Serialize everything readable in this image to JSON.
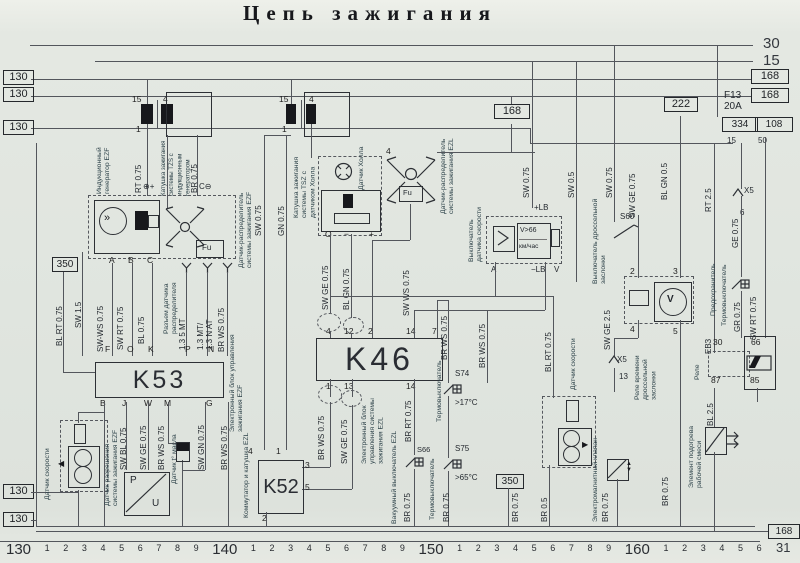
{
  "title": "Цепь зажигания",
  "tags": {
    "track": "130",
    "t168": "168",
    "t222": "222",
    "t350": "350",
    "t334": "334",
    "t108": "108",
    "bus30": "30",
    "bus15": "15",
    "bus31": "31"
  },
  "blocks": {
    "k53": {
      "id": "K53",
      "pins_top": [
        "F",
        "O",
        "K",
        "P",
        "N"
      ],
      "pins_bottom": [
        "B",
        "J",
        "W",
        "M",
        "G"
      ]
    },
    "k46": {
      "id": "K46",
      "pins_top": [
        "4",
        "12",
        "2",
        "14",
        "7"
      ],
      "pins_bottom": [
        "1",
        "13",
        "14"
      ]
    },
    "k52": {
      "id": "K52",
      "pins": {
        "p4": "4",
        "p1": "1",
        "p3": "3",
        "p5": "5",
        "p2": "2"
      }
    }
  },
  "components": [
    "Индукционный генератор EZF",
    "Катушка зажигания системы TZS с индукционным генератором",
    "Датчик-распределитель системы зажигания EZF",
    "Разъем датчика распределителя",
    "Катушка зажигания системы TSZ с датчиком Холла",
    "Датчик Холла",
    "Датчик-распределитель системы зажигания EZL",
    "Электронный блок управления зажигания EZF",
    "Электронный блок управления системы зажигания EZL",
    "Коммутатор и катушка EZL",
    "Датчик скорости",
    "Датчик разрешения системы зажигания EZF",
    "Датчик t° масла",
    "Выключатель датчика скорости",
    "Выключатель дроссельной заслонки",
    "Термовыключатель",
    "Термовыключатель",
    "Вакуумный выключатель EZL",
    "Датчик скорости",
    "Электромагнитный клапан",
    "Реле времени дроссельной заслонки",
    "Реле",
    "Предохранитель",
    "Термовыключатель",
    "Элемент подогрева рабочей смеси"
  ],
  "wires": [
    "RT 0.75",
    "BR 0.75",
    "SW 0.75",
    "GN 0.75",
    "BL RT 0.75",
    "SW 1.5",
    "SW-WS 0.75",
    "SW RT 0.75",
    "BL 0.75",
    "1.3 5 MT",
    "1.3 MT/",
    "1.3 N AT",
    "BR WS 0.75",
    "SW BL 0.75",
    "SW GE 0.75",
    "BR WS 0.75",
    "SW GN 0.75",
    "BR WS 0.75",
    "SW GE 0.75",
    "BL GN 0.75",
    "SW WS 0.75",
    "SW 0.75",
    "SW 0.5",
    "SW 0.75",
    "SW GE 0.75",
    "BL GN 0.5",
    "RT 2.5",
    "GE 0.75",
    "GR 0.75",
    "SW RT 0.75",
    "SW GE 2.5",
    "BR WS 0.75",
    "BR WS 0.75",
    "BR RT 0.75",
    "BR 0.75",
    "BR 0.75",
    "BR 0.75",
    "BR 0.5",
    "BL RT 0.75",
    "BR 0.75",
    "BR 0.75",
    "BL 2.5",
    "BR WS 0.75",
    "SW GE 0.75"
  ],
  "marks": {
    "s60": "S60",
    "s74": "S74",
    "s75": "S75",
    "s66": "S66",
    "deg17": ">17°C",
    "deg65": ">65°C",
    "v66": "V>66",
    "kmh": "км/час",
    "fu": "Fu",
    "e83": "ЕВЗ",
    "plus_lb": "+LB",
    "minus_lb": "−LB",
    "volt": "V",
    "amp": "A",
    "x5": "X5",
    "pin13": "13",
    "pin6": "6",
    "gen_plus": "⊕+",
    "gen_c": "C⊖",
    "hall_o": "O",
    "hall_minus": "−",
    "hall_plus": "+",
    "dist4": "4",
    "coil15": "15",
    "coil4": "4",
    "coil1": "1",
    "abc_a": "A",
    "abc_b": "B",
    "abc_c": "C",
    "relay2": "2",
    "relay3": "3",
    "relay4": "4",
    "relay5": "5",
    "fuse30": "30",
    "fuse66": "66",
    "fuse87": "87",
    "fuse85": "85",
    "f13": "F13",
    "f13amp": "20A",
    "n15": "15",
    "n50": "50"
  },
  "scale": [
    "130",
    "1",
    "2",
    "3",
    "4",
    "5",
    "6",
    "7",
    "8",
    "9",
    "140",
    "1",
    "2",
    "3",
    "4",
    "5",
    "6",
    "7",
    "8",
    "9",
    "150",
    "1",
    "2",
    "3",
    "4",
    "5",
    "6",
    "7",
    "8",
    "9",
    "160",
    "1",
    "2",
    "3",
    "4",
    "5",
    "6"
  ]
}
